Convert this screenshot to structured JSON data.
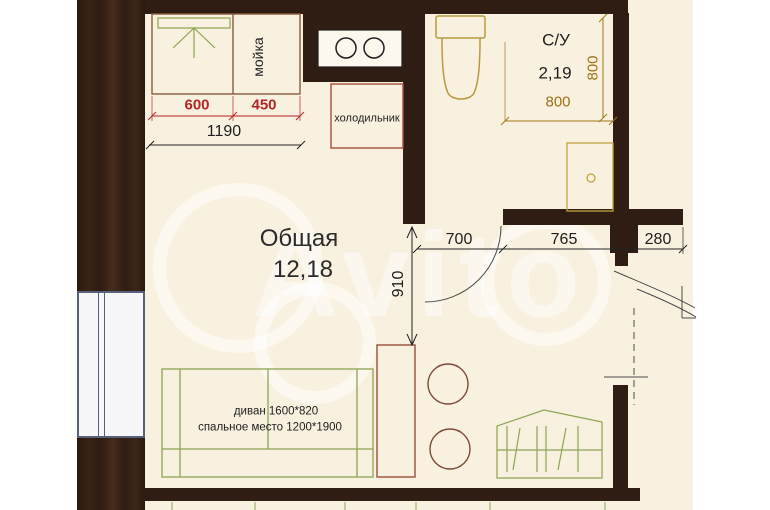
{
  "watermark": "Avito",
  "rooms": {
    "living": {
      "label": "Общая",
      "area": "12,18"
    },
    "bathroom": {
      "label": "С/У",
      "area": "2,19"
    }
  },
  "fixtures": {
    "sink": "мойка",
    "fridge": "холодильник"
  },
  "furniture": {
    "sofa_line1": "диван 1600*820",
    "sofa_line2": "спальное место 1200*1900"
  },
  "dimensions": {
    "cabinet_left": "600",
    "cabinet_right": "450",
    "kitchen_total": "1190",
    "opening": "700",
    "hall": "765",
    "entry": "280",
    "depth": "910",
    "shower_width": "800",
    "shower_height": "800"
  },
  "colors": {
    "wall": "#2f1d14",
    "floor": "#f9f1e0",
    "furniture_green": "#8ca452",
    "fixture_yellow": "#b89a3e",
    "dim_red": "#b42424",
    "dim_orange": "#9c7013",
    "window_frame": "#56627c"
  }
}
